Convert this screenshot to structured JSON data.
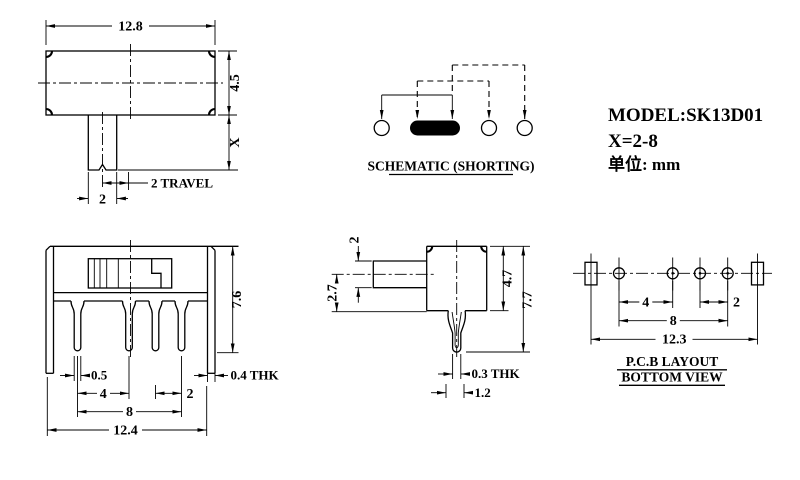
{
  "top_view": {
    "width": "12.8",
    "height": "4.5",
    "x_label": "X",
    "travel": "2 TRAVEL",
    "knob_width": "2"
  },
  "schematic": {
    "title": "SCHEMATIC (SHORTING)"
  },
  "info": {
    "model": "MODEL:SK13D01",
    "x_range": "X=2-8",
    "unit": "单位: mm"
  },
  "front_view": {
    "height": "7.6",
    "pin_width": "0.5",
    "pitch_4": "4",
    "pitch_2": "2",
    "span": "8",
    "width": "12.4",
    "bracket_thk": "0.4 THK"
  },
  "side_view": {
    "knob_thk": "2",
    "knob_center": "2.7",
    "body_height": "4.7",
    "height": "7.7",
    "pin_thk": "0.3 THK",
    "pin_tip": "1.2"
  },
  "pcb_layout": {
    "title": "P.C.B LAYOUT",
    "subtitle": "BOTTOM VIEW",
    "pitch_4": "4",
    "pitch_2": "2",
    "span": "8",
    "width": "12.3"
  },
  "colors": {
    "ink": "#000000",
    "paper": "#ffffff"
  }
}
